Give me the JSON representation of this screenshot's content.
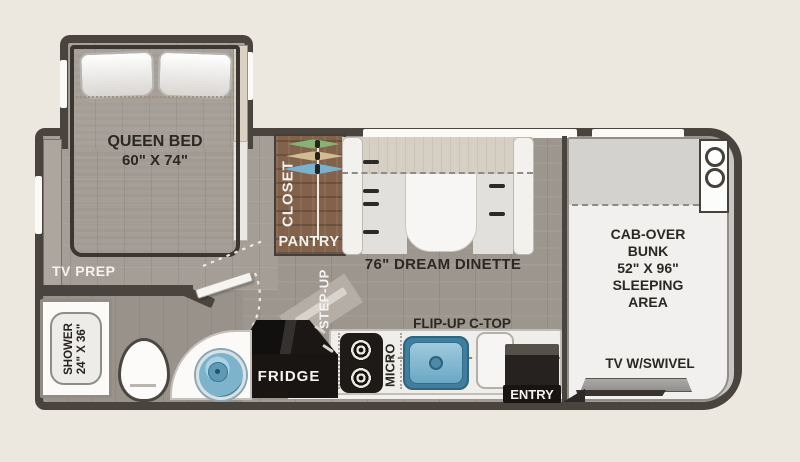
{
  "colors": {
    "background": "#ece8e0",
    "wall": "#4a443e",
    "floor": "#9c968e",
    "closet_wood": "#82624a",
    "sink_blue": "#6aa8c4",
    "fixture_white": "#f1f0ee"
  },
  "bedroom": {
    "bed": "QUEEN BED",
    "bed_size": "60\" X 74\"",
    "tv_prep": "TV PREP",
    "closet": "CLOSET",
    "pantry": "PANTRY"
  },
  "bathroom": {
    "shower": "SHOWER",
    "shower_size": "24\" X 36\""
  },
  "living": {
    "dinette": "76\" DREAM DINETTE",
    "step_up": "STEP-UP"
  },
  "kitchen": {
    "fridge": "FRIDGE",
    "micro": "MICRO",
    "flip_up_ctop": "FLIP-UP C-TOP",
    "entry": "ENTRY"
  },
  "cab": {
    "bunk_line1": "CAB-OVER",
    "bunk_line2": "BUNK",
    "bunk_line3": "52\" X 96\"",
    "bunk_line4": "SLEEPING",
    "bunk_line5": "AREA",
    "tv": "TV W/SWIVEL"
  }
}
